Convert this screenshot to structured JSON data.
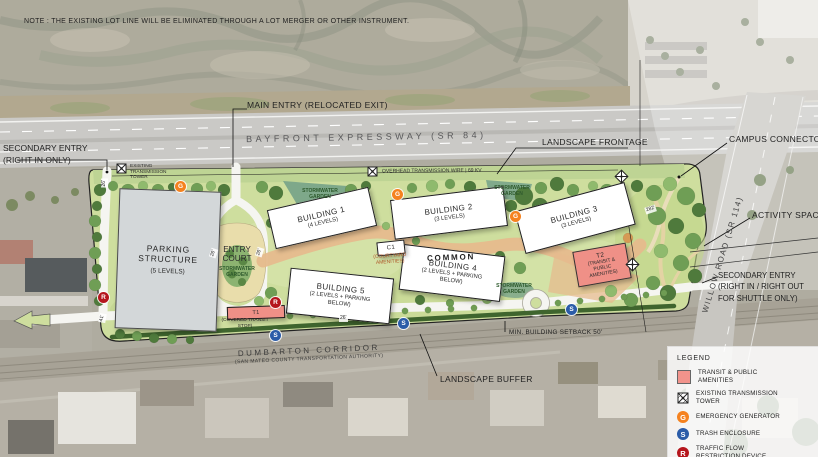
{
  "note": "NOTE : THE EXISTING LOT LINE WILL BE ELIMINATED THROUGH A LOT MERGER OR OTHER INSTRUMENT.",
  "roads": {
    "bayfront": "BAYFRONT EXPRESSWAY  (SR 84)",
    "willow": "WILLOW ROAD (SR 114)",
    "dumbarton": "DUMBARTON CORRIDOR",
    "dumbarton_sub": "(SAN MATEO COUNTY TRANSPORTATION AUTHORITY)"
  },
  "entries": {
    "main": "MAIN ENTRY (RELOCATED EXIT)",
    "secondary_left_line1": "SECONDARY ENTRY",
    "secondary_left_line2": "(RIGHT IN ONLY)",
    "secondary_right_line1": "SECONDARY ENTRY",
    "secondary_right_line2": "(RIGHT IN /  RIGHT OUT",
    "secondary_right_line3": "FOR SHUTTLE ONLY)"
  },
  "features": {
    "landscape_frontage": "LANDSCAPE FRONTAGE",
    "campus_connector": "CAMPUS CONNECTOR",
    "activity_space": "ACTIVITY SPACE",
    "landscape_buffer": "LANDSCAPE BUFFER",
    "min_setback": "MIN. BUILDING SETBACK 50'",
    "overhead_wire": "OVERHEAD TRANSMISSION WIRE | 69 KV",
    "existing_tower": "EXISTING TRANSMISSION TOWER",
    "stormwater_garden_line1": "STORMWATER",
    "stormwater_garden_line2": "GARDEN",
    "common": "COMMON"
  },
  "buildings": {
    "b1_name": "BUILDING 1",
    "b1_sub": "(4 LEVELS)",
    "b2_name": "BUILDING 2",
    "b2_sub": "(3 LEVELS)",
    "b3_name": "BUILDING 3",
    "b3_sub": "(3 LEVELS)",
    "b4_name": "BUILDING 4",
    "b4_sub": "(2 LEVELS + PARKING BELOW)",
    "b5_name": "BUILDING 5",
    "b5_sub": "(2 LEVELS + PARKING BELOW)",
    "c1_name": "C1",
    "c1_sub": "(COURTYARD AMENITIES)",
    "t1_name": "T1",
    "t1_sub": "(COVERED TRANSIT STOP)",
    "t2_name": "T2",
    "t2_sub": "(TRANSIT & PUBLIC AMENITIES)",
    "parking_line1": "PARKING",
    "parking_line2": "STRUCTURE",
    "parking_sub": "(5 LEVELS)",
    "entry_court_line1": "ENTRY",
    "entry_court_line2": "COURT"
  },
  "dimensions": {
    "d26": "26'",
    "d41": "41'",
    "d282": "282'"
  },
  "markers": {
    "generator": "G",
    "trash": "S",
    "restriction": "R"
  },
  "legend": {
    "title": "LEGEND",
    "items": [
      {
        "label": "TRANSIT & PUBLIC AMENITIES"
      },
      {
        "label": "EXISTING TRANSMISSION TOWER"
      },
      {
        "label": "EMERGENCY GENERATOR"
      },
      {
        "label": "TRASH ENCLOSURE"
      },
      {
        "label": "TRAFFIC FLOW RESTRICTION DEVICE"
      }
    ],
    "colors": {
      "transit": "#f2938b",
      "generator": "#f5821f",
      "trash": "#2b5ca8",
      "restriction": "#b5161d"
    }
  }
}
